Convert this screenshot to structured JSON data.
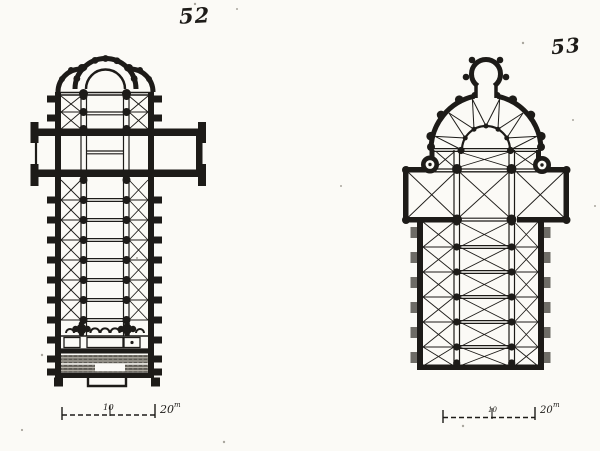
{
  "page": {
    "background": "#fbfaf6",
    "ink": "#1d1b18",
    "kind": "engraved plate with two church floor plans"
  },
  "figures": [
    {
      "number": "52",
      "scale_bar": {
        "mid_label": "10",
        "end_value": "20",
        "end_unit": "m"
      }
    },
    {
      "number": "53",
      "scale_bar": {
        "mid_label": "10",
        "end_value": "20",
        "end_unit": "m"
      }
    }
  ]
}
